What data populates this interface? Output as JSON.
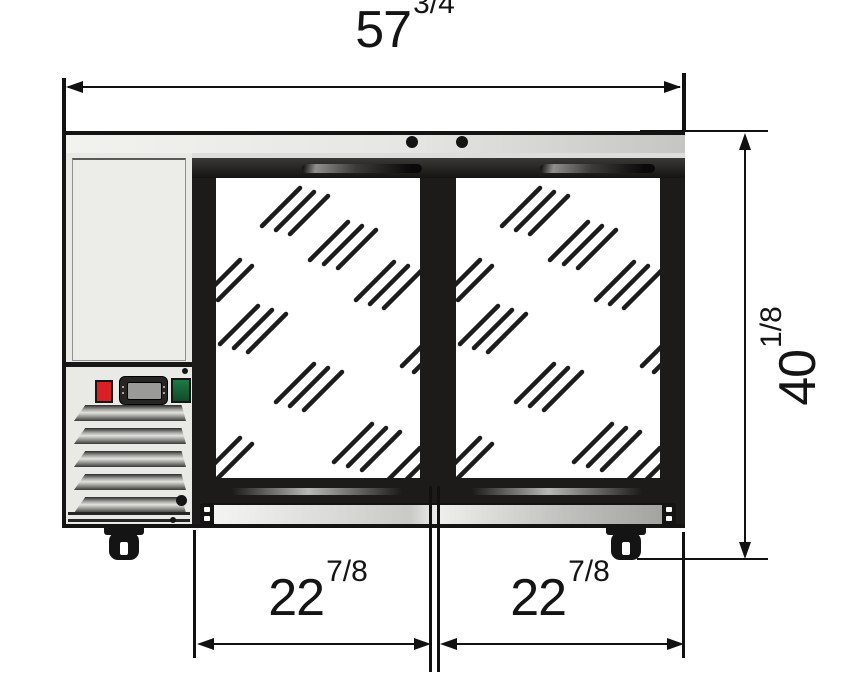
{
  "diagram": {
    "type": "front-elevation-dimension-drawing",
    "dimensions": {
      "overall_width": {
        "whole": "57",
        "frac": "3/4"
      },
      "overall_height": {
        "whole": "40",
        "frac": "1/8"
      },
      "left_door_width": {
        "whole": "22",
        "frac": "7/8"
      },
      "right_door_width": {
        "whole": "22",
        "frac": "7/8"
      }
    },
    "colors": {
      "line": "#111111",
      "frame_black": "#1d1b1a",
      "panel_gray": "#e9e9e6",
      "counter_gray": "#e6e6e3",
      "red_button": "#d92027",
      "green_button": "#1e7a45"
    }
  }
}
